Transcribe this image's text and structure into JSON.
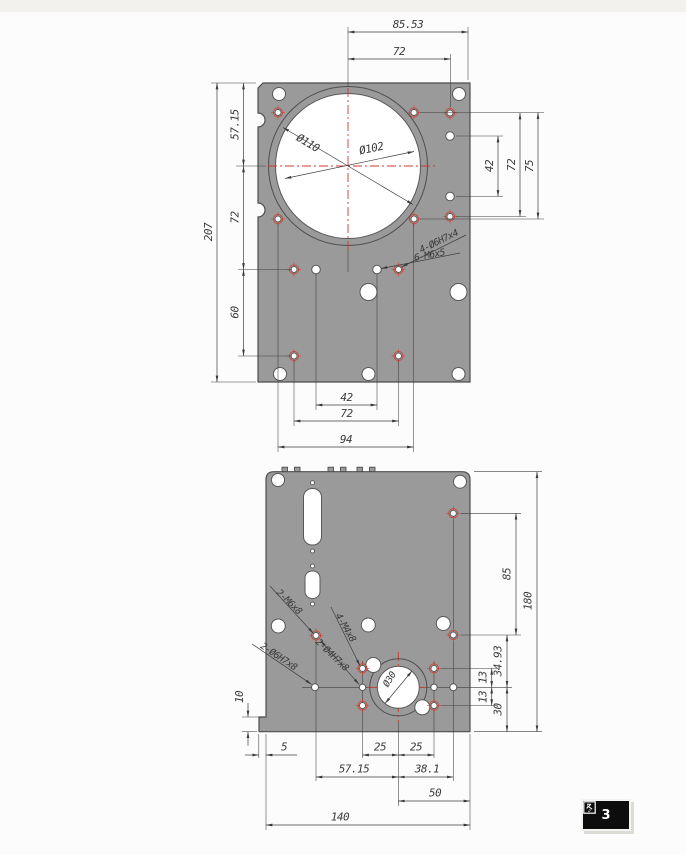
{
  "figure_tag": {
    "label": "图 3",
    "number": "3"
  },
  "colors": {
    "plate_fill": "#9a9a9a",
    "outline": "#4e4e4e",
    "dimension": "#3e3e3e",
    "centerline_red": "#cf3b2d",
    "hole_fill": "#ffffff",
    "tag_bg": "#0d0d0d",
    "tag_text": "#ffffff"
  },
  "top_view": {
    "dim_top_outer": "85.53",
    "dim_top_inner": "72",
    "dim_left_upper": "57.15",
    "dim_left_mid": "72",
    "dim_left_lower": "60",
    "dim_left_total": "207",
    "dim_bottom_inner": "42",
    "dim_bottom_mid": "72",
    "dim_bottom_outer": "94",
    "dim_right_inner": "42",
    "dim_right_mid": "72",
    "dim_right_outer": "75",
    "dia_outer": "Ø110",
    "dia_inner": "Ø102",
    "note_reamed_holes": "4-Ø6H7x4",
    "note_tapped_holes": "6-M6x5"
  },
  "bottom_view": {
    "dim_right_upper": "85",
    "dim_right_total": "180",
    "dim_right_3493": "34.93",
    "dim_right_13_upper": "13",
    "dim_right_13_lower": "13",
    "dim_right_30": "30",
    "dim_left_10": "10",
    "dim_bottom_5": "5",
    "dim_bottom_25_left": "25",
    "dim_bottom_25_right": "25",
    "dim_bottom_5715": "57.15",
    "dim_bottom_381": "38.1",
    "dim_bottom_50": "50",
    "dim_bottom_140": "140",
    "dia_boss": "Ø30",
    "note_m6": "2-M6x8",
    "note_m4": "4-M4x8",
    "note_h7_6": "2-Ø6H7x8",
    "note_h7_4": "2-Ø4H7x8"
  }
}
